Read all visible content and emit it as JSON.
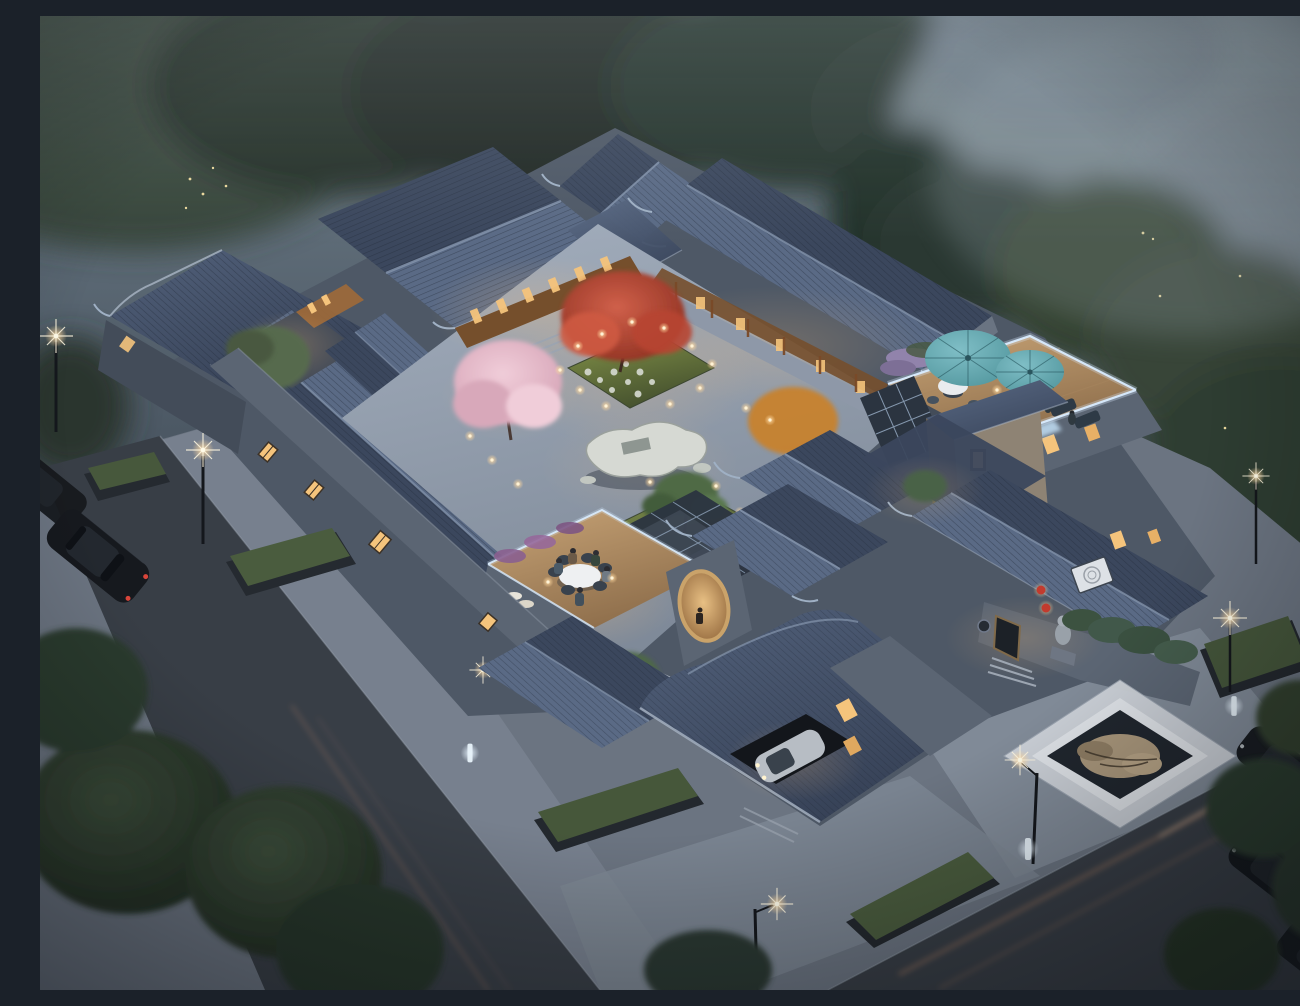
{
  "scene": {
    "title": "Aerial dusk rendering of a traditional Chinese siheyuan courtyard residence",
    "description": "Bird's-eye 3D architectural rendering at dusk: a walled courtyard compound with dark blue-grey tiled roofs and upturned eaves, warmly lit lattice windows, a central landscaped courtyard with cherry blossom and red maple trees, a scholar's rock, rooftop terraces with teal umbrellas and LED-edged glass railings, a dining terrace with guests, an entrance with a stone lion and red lanterns, a sunken rock pond on the plaza, street lamps, parked cars and misty trees all around.",
    "time_of_day": "dusk"
  },
  "labels": {
    "scene": "siheyuan courtyard residence at dusk",
    "background_trees": "misty trees and hazy surroundings",
    "left_road": "street along the west side",
    "right_road": "street along the south-east side",
    "ground": "stone-paved sidewalk and plaza",
    "compound": "walled courtyard compound",
    "gate_roof": "entrance gate roof",
    "north_hall": "north hall with lit wooden facade",
    "northeast_wing": "north-east wing and veranda",
    "northwest_building": "north-west corner building",
    "west_wing": "west wing with lit lattice windows",
    "courtyard": "central landscaped courtyard",
    "cherry_tree": "pink cherry blossom tree",
    "maple_tree": "red maple tree",
    "rock_sculpture": "scholar's rock centerpiece",
    "bonsai": "courtyard bonsai pine",
    "rooftop_terrace": "rooftop lounge terrace with umbrellas",
    "dining_terrace": "rooftop dining terrace with guests",
    "moon_window": "oval moon window",
    "glass_corridor": "glazed corridor skylight",
    "pavilions": "twin courtyard pavilion roofs",
    "tower": "two-storey brick pavilion",
    "entrance": "south-east entrance with lion and lanterns",
    "garage": "garage with parked silver car",
    "pond": "sunken rock pond on plaza",
    "planters": "raised grass planters",
    "street_lamps": "lit street lamps",
    "cars": "cars on the streets",
    "foreground_trees": "dark foreground trees"
  },
  "inventory": {
    "teal_umbrellas": 2,
    "red_lanterns": 2,
    "stone_lion": 1,
    "street_side_sedan": 1,
    "garage_car": 1,
    "parked_cars_right": 3,
    "terrace_round_tables": 2,
    "dining_guests": 5,
    "water_feature": "rectangular sunken rock pond",
    "lighting": "warm lantern glows with cool LED strip railings"
  },
  "palette": {
    "sky-top": "#71808b",
    "sky-mid": "#4a5662",
    "sky-low": "#272e38",
    "mist": "#9aa8b0",
    "tree-dark": "#222e26",
    "tree-mid": "#35453a",
    "tree-mist": "#7c8b94",
    "ground": "#6b7481",
    "plaza-light": "#848e9b",
    "road": "#383e46",
    "curb": "#9aa3af",
    "trail-warm": "#e29a6e",
    "roof-hi": "#5a6a85",
    "roof-lo": "#3b475d",
    "ridge": "#8292aa",
    "eave-light": "#aab6c6",
    "wall": "#5b6573",
    "wall-dark": "#434c59",
    "gable": "#6a7482",
    "brick": "#8e8374",
    "brick-dark": "#6f6659",
    "wood": "#754f2c",
    "wood-lit": "#a06a38",
    "window-glow": "#f5c47c",
    "lamp-warm": "#ffd9a0",
    "led": "#d9ecff",
    "lawn-hi": "#87974a",
    "lawn-lo": "#47532f",
    "blossom": "#e7bdcc",
    "maple": "#c24936",
    "autumn": "#c8822f",
    "umbrella-teal": "#54989f",
    "deck": "#c7a376",
    "rock": "#d6d9d3",
    "water": "#20262e",
    "marble": "#ccd1d7",
    "car-dark": "#16191e",
    "car-silver": "#b7bdc4",
    "tail-red": "#d8453a",
    "lantern": "#c23b2e",
    "flower-purple": "#9183ab",
    "glass": "#2b3440",
    "glass-frame": "#8fa3ba",
    "glass-glow": "#bcd8ee"
  }
}
